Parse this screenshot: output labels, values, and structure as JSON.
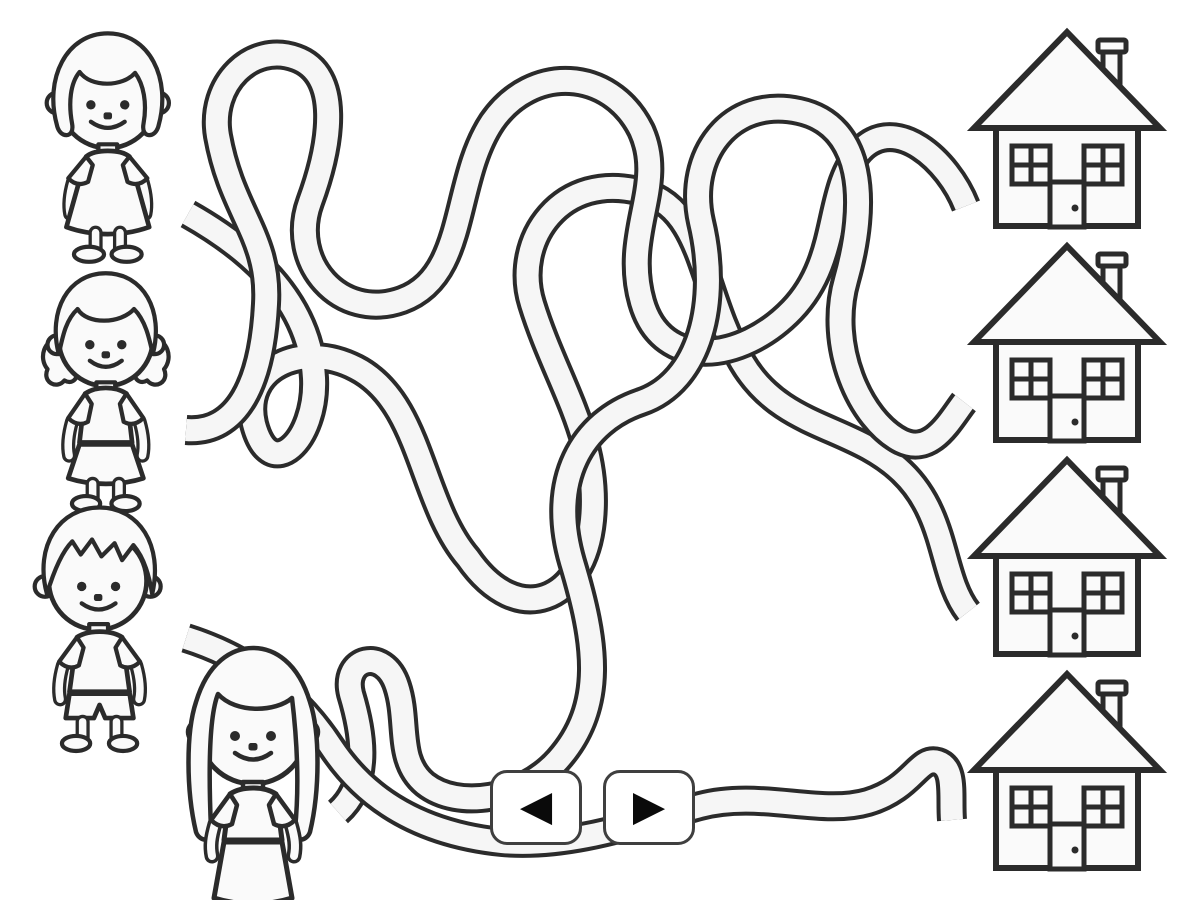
{
  "page": {
    "background_color": "#ffffff",
    "description": "Match-the-tangled-lines worksheet: four children on the left connect through winding paths to four houses on the right"
  },
  "palette": {
    "outline": "#2b2b2b",
    "path_fill": "#f6f6f6",
    "figure_fill": "#fafafa",
    "button_border": "#3f3f3f",
    "button_background": "#ffffff",
    "arrow_color": "#0a0a0a"
  },
  "children": [
    {
      "id": 1,
      "label": "girl with bob haircut wearing a dress"
    },
    {
      "id": 2,
      "label": "girl with pigtails wearing shirt and skirt"
    },
    {
      "id": 3,
      "label": "boy with messy hair wearing shirt and shorts"
    },
    {
      "id": 4,
      "label": "girl with long hair wearing shirt and skirt"
    }
  ],
  "houses": [
    {
      "id": 1,
      "label": "house with chimney, two windows and a door"
    },
    {
      "id": 2,
      "label": "house with chimney, two windows and a door"
    },
    {
      "id": 3,
      "label": "house with chimney, two windows and a door"
    },
    {
      "id": 4,
      "label": "house with chimney, two windows and a door"
    }
  ],
  "maze": {
    "path_count": 4,
    "style": "tangled tube lines with loops"
  },
  "controls": {
    "prev": {
      "icon": "arrow-left-icon",
      "glyph": "◀"
    },
    "next": {
      "icon": "arrow-right-icon",
      "glyph": "▶"
    }
  }
}
